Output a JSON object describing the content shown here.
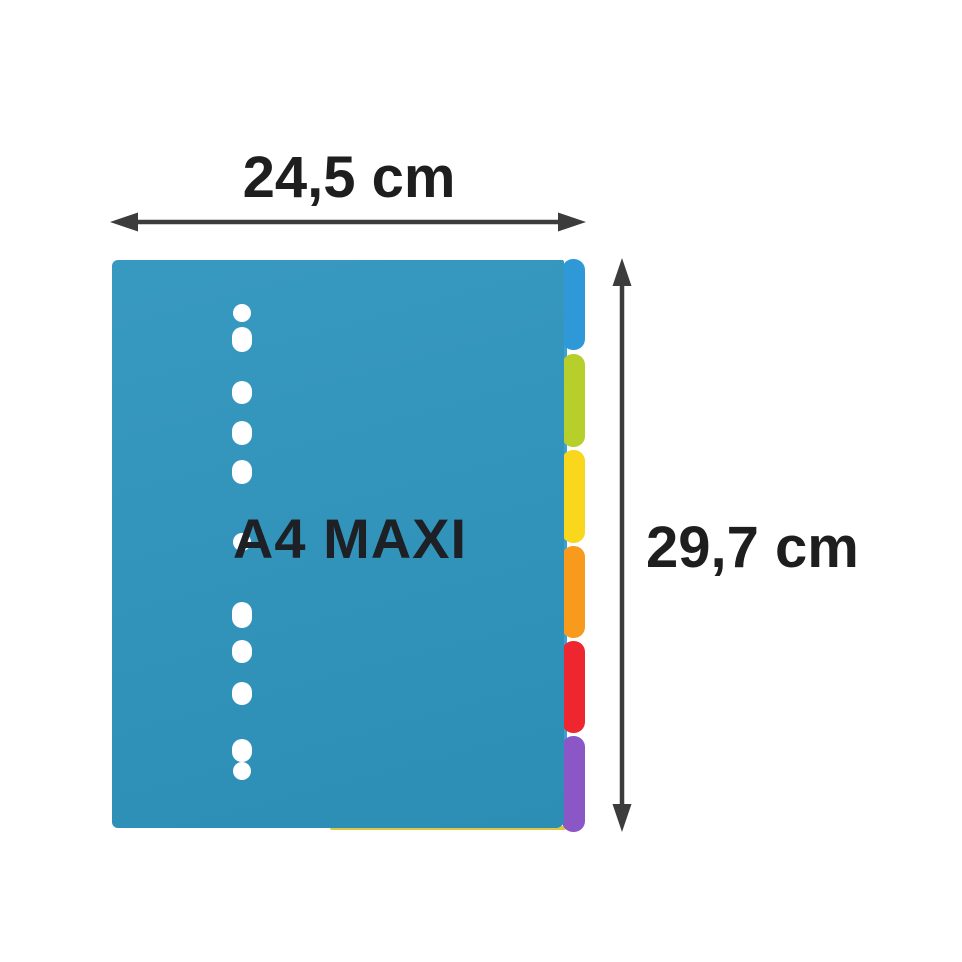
{
  "annotations": {
    "width_label": "24,5 cm",
    "height_label": "29,7 cm",
    "label_color": "#1e1e1e",
    "arrow_color": "#3c3c3c"
  },
  "product": {
    "print_label": "A4 MAXI",
    "print_color": "#1d2024",
    "body_color": "#2e94bd",
    "edge_color": "#3aa1d7",
    "under_sheet_edge_color": "#ddc93f",
    "hole_count": 11,
    "tabs": [
      {
        "name": "blue",
        "color": "#2f99d8"
      },
      {
        "name": "green",
        "color": "#b6cf2b"
      },
      {
        "name": "yellow",
        "color": "#f8d71c"
      },
      {
        "name": "orange",
        "color": "#f89b1c"
      },
      {
        "name": "red",
        "color": "#ee2630"
      },
      {
        "name": "purple",
        "color": "#8b57c6"
      }
    ]
  }
}
